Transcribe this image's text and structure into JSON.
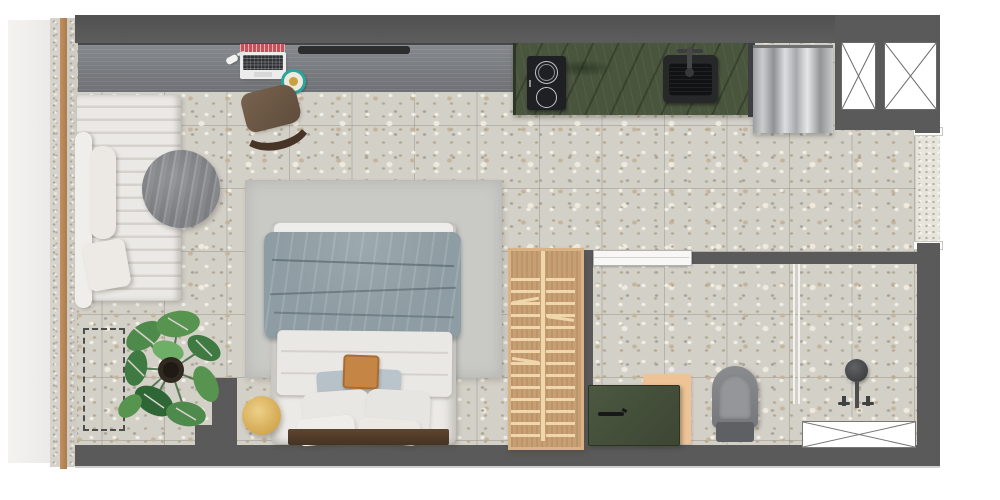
{
  "document": {
    "title": "Studio apartment floor plan",
    "view": "top-down rendered plan",
    "background": "#ffffff"
  },
  "areas": {
    "living": {
      "label": "Living / sleeping area"
    },
    "kitchen": {
      "label": "Kitchenette"
    },
    "bathroom": {
      "label": "Bathroom"
    },
    "balcony": {
      "label": "Balcony / window front"
    },
    "entry": {
      "label": "Entry"
    }
  },
  "items": {
    "desk": {
      "label": "Wall-mounted desk / media board",
      "color": "#7d8084"
    },
    "laptop": {
      "label": "Laptop with notebook",
      "color": "#ececec"
    },
    "plate": {
      "label": "Small teal dish",
      "color": "#2ba59a"
    },
    "desk_chair": {
      "label": "Desk chair",
      "color": "#6e5947"
    },
    "daybed": {
      "label": "Channel-tufted daybed sofa",
      "color": "#e9e7e3"
    },
    "sofa_pillow": {
      "label": "Sofa cushion",
      "color": "#edeae6"
    },
    "round_table": {
      "label": "Round coffee table",
      "color": "#8a8c8e"
    },
    "plant": {
      "label": "Monstera floor plant",
      "color": "#4e8a4c"
    },
    "floor_marker": {
      "label": "Dashed floor marking",
      "color": "#4e4e4e"
    },
    "rug": {
      "label": "Area rug",
      "color": "#c9cac6"
    },
    "bed": {
      "label": "Double bed",
      "color": "#eceae7"
    },
    "duvet": {
      "label": "Gray duvet",
      "color": "#8e9da3"
    },
    "accent_pillow": {
      "label": "Ochre accent pillow",
      "color": "#c58544"
    },
    "bed_frame": {
      "label": "Wooden bed frame",
      "color": "#54402c"
    },
    "stool": {
      "label": "Round wooden side stool",
      "color": "#d8ad55"
    },
    "wardrobe": {
      "label": "Slatted wardrobe",
      "color": "#c79f74"
    },
    "counter": {
      "label": "Green stone kitchen counter",
      "color": "#4a553e"
    },
    "cooktop": {
      "label": "Two-zone induction cooktop",
      "color": "#202124"
    },
    "sink": {
      "label": "Kitchen sink",
      "color": "#242527"
    },
    "fridge": {
      "label": "Stainless fridge",
      "color": "#b9babc"
    },
    "shaft": {
      "label": "Service shaft",
      "color": "#ffffff"
    },
    "bathroom_door": {
      "label": "Bathroom sliding door",
      "color": "#f8f7f5"
    },
    "vanity": {
      "label": "Green bathroom vanity",
      "color": "#47513c"
    },
    "vanity_board": {
      "label": "Wooden vanity board",
      "color": "#eec497"
    },
    "toilet": {
      "label": "Toilet",
      "color": "#808285"
    },
    "shower": {
      "label": "Shower head and valves",
      "color": "#454749"
    },
    "glass_partition": {
      "label": "Shower glass partition",
      "color": "#f3f2ef"
    },
    "shower_tray": {
      "label": "Shower tray",
      "color": "#ffffff"
    },
    "window_frame": {
      "label": "Window / sliding door frame",
      "color": "#b7895a"
    }
  },
  "palette": {
    "wall": "#5a5a5a",
    "floor": "#d3d0c8",
    "balcony": "#f0efed",
    "counter_green": "#4a553e",
    "wood_light": "#d8ad55",
    "wood_oak": "#c79f74",
    "textile_gray": "#8e9da3",
    "accent_ochre": "#c58544",
    "teal": "#2ba59a"
  }
}
